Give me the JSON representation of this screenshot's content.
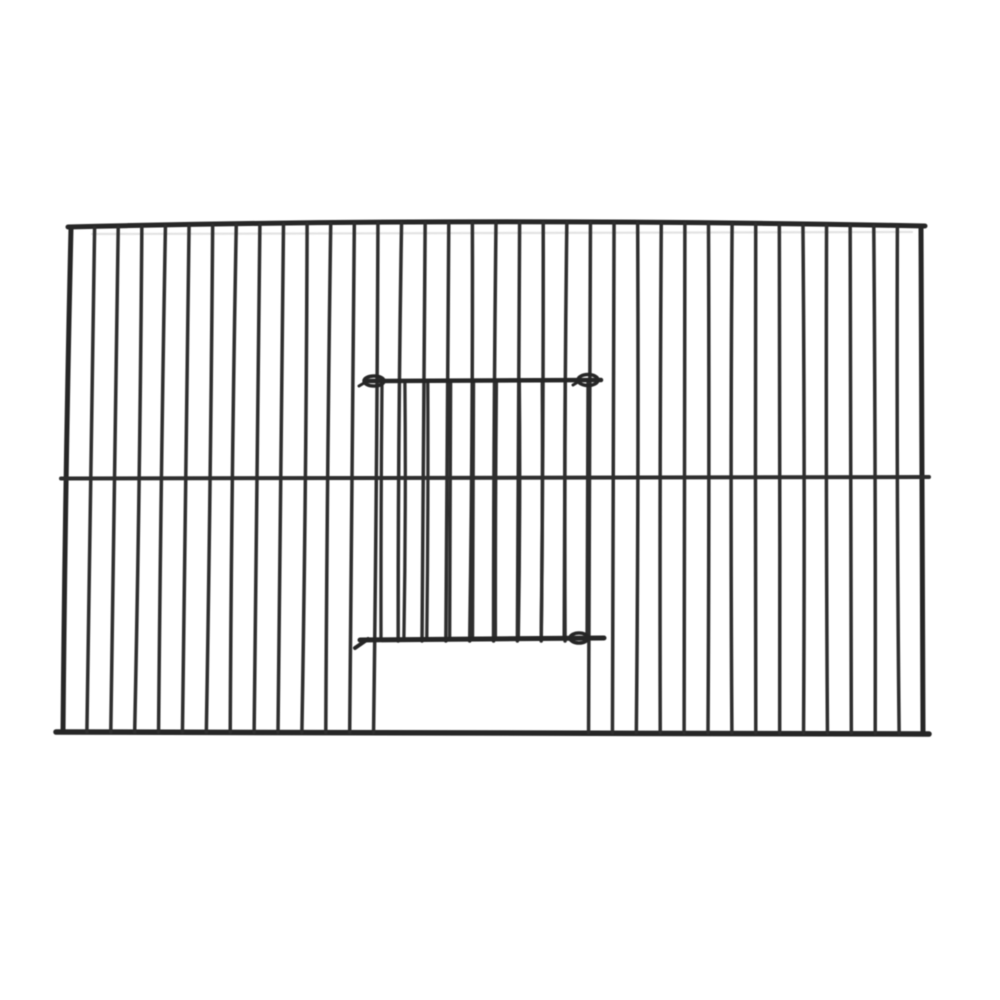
{
  "image_description": "Product photo: black wire bird cage front panel with vertical bars, a horizontal mid wire, and a sliding wire door hooked onto the bars above a rectangular open feed hole at bottom centre",
  "scene": {
    "background_color": "#ffffff",
    "wire_color": "#2e2e2e",
    "frame_color": "#262626",
    "ghost_color": "#c8c8c8",
    "canvas": {
      "width": 1000,
      "height": 1000
    },
    "frame": {
      "top_left_x": 71,
      "top_left_y": 227,
      "top_right_x": 921,
      "top_right_y": 226,
      "bottom_left_x": 63,
      "bottom_left_y": 732,
      "bottom_right_x": 923,
      "bottom_right_y": 733,
      "top_bow_y": 217,
      "top_rail_x1": 68,
      "top_rail_x2": 925,
      "bottom_rail_x1": 56,
      "bottom_rail_x2": 929,
      "bottom_rail_y1": 732,
      "bottom_rail_y2": 734,
      "frame_stroke": 5,
      "bottom_rail_stroke": 5.5
    },
    "ghost_line": {
      "x1": 92,
      "y1": 234,
      "x2": 912,
      "y2": 232,
      "stroke": 2.2,
      "opacity": 0.5
    },
    "bars": {
      "count_total": 37,
      "stroke": 3.5,
      "door_gap_first_index": 14,
      "door_gap_last_index": 21,
      "door_gap_bottom_y": 641
    },
    "mid_wire": {
      "x1": 61,
      "y1": 478.5,
      "x2": 929,
      "y2": 477,
      "stroke": 4
    },
    "door": {
      "top_wire": {
        "x1": 365,
        "y1": 381,
        "x2": 601,
        "y2": 380,
        "stroke": 4.5
      },
      "top_hooks": [
        {
          "cx": 374,
          "cy": 381,
          "rx": 10,
          "ry": 5
        },
        {
          "cx": 588,
          "cy": 380,
          "rx": 10,
          "ry": 5.5
        }
      ],
      "bottom_wire": {
        "x1": 360,
        "y1": 640,
        "x2": 604,
        "y2": 638,
        "stroke": 5
      },
      "bottom_hooks": [
        {
          "cx": 579,
          "cy": 638,
          "rx": 9,
          "ry": 5
        }
      ],
      "bottom_left_tail": {
        "x1": 368,
        "y1": 639,
        "x2": 355,
        "y2": 648,
        "stroke": 4
      },
      "door_bars": {
        "x_start": 382,
        "x_end": 588,
        "count": 10,
        "y1": 381,
        "y2": 639,
        "stroke": 3.3
      }
    }
  }
}
